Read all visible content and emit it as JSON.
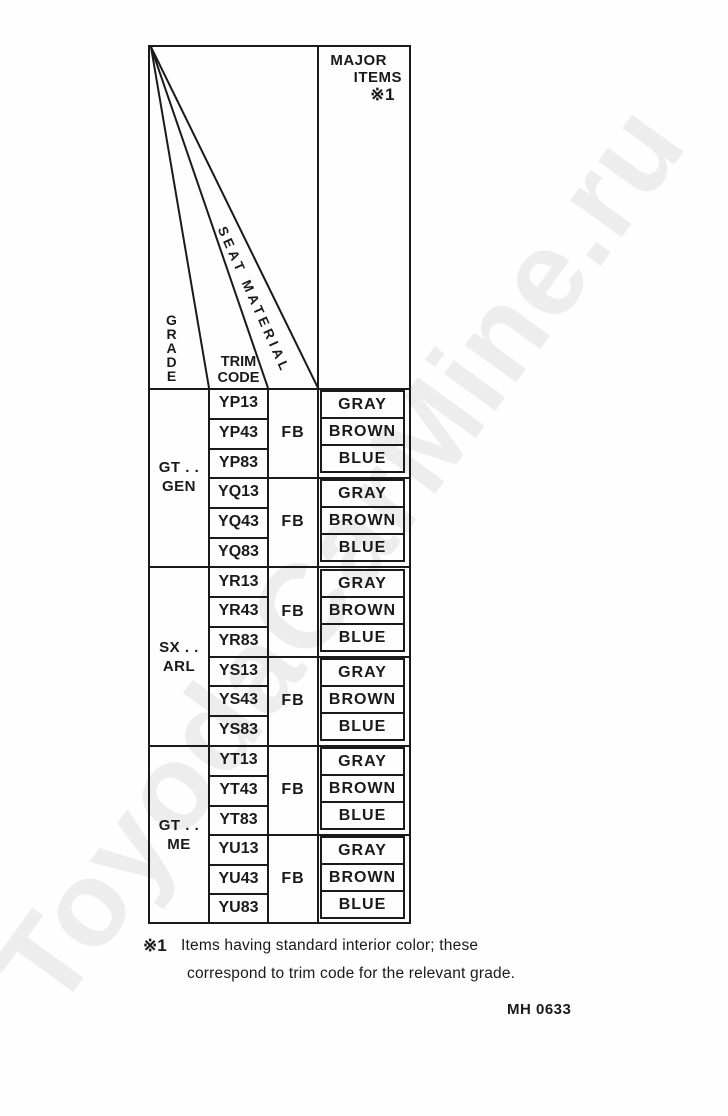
{
  "watermark": {
    "text": "ToyodaCarMine.ru",
    "color": "#ededed"
  },
  "header": {
    "major_items": {
      "line1": "MAJOR",
      "line2": "ITEMS",
      "note_ref": "※1"
    },
    "grade": "GRADE",
    "trim_code": {
      "line1": "TRIM",
      "line2": "CODE"
    },
    "seat_material": "SEAT MATERIAL"
  },
  "table": {
    "groups": [
      {
        "grade": {
          "line1": "GT . .",
          "line2": "GEN"
        },
        "trios": [
          {
            "material": "FB",
            "rows": [
              {
                "trim": "YP13",
                "item": "GRAY"
              },
              {
                "trim": "YP43",
                "item": "BROWN"
              },
              {
                "trim": "YP83",
                "item": "BLUE"
              }
            ]
          },
          {
            "material": "FB",
            "rows": [
              {
                "trim": "YQ13",
                "item": "GRAY"
              },
              {
                "trim": "YQ43",
                "item": "BROWN"
              },
              {
                "trim": "YQ83",
                "item": "BLUE"
              }
            ]
          }
        ]
      },
      {
        "grade": {
          "line1": "SX . .",
          "line2": "ARL"
        },
        "trios": [
          {
            "material": "FB",
            "rows": [
              {
                "trim": "YR13",
                "item": "GRAY"
              },
              {
                "trim": "YR43",
                "item": "BROWN"
              },
              {
                "trim": "YR83",
                "item": "BLUE"
              }
            ]
          },
          {
            "material": "FB",
            "rows": [
              {
                "trim": "YS13",
                "item": "GRAY"
              },
              {
                "trim": "YS43",
                "item": "BROWN"
              },
              {
                "trim": "YS83",
                "item": "BLUE"
              }
            ]
          }
        ]
      },
      {
        "grade": {
          "line1": "GT . .",
          "line2": "ME"
        },
        "trios": [
          {
            "material": "FB",
            "rows": [
              {
                "trim": "YT13",
                "item": "GRAY"
              },
              {
                "trim": "YT43",
                "item": "BROWN"
              },
              {
                "trim": "YT83",
                "item": "BLUE"
              }
            ]
          },
          {
            "material": "FB",
            "rows": [
              {
                "trim": "YU13",
                "item": "GRAY"
              },
              {
                "trim": "YU43",
                "item": "BROWN"
              },
              {
                "trim": "YU83",
                "item": "BLUE"
              }
            ]
          }
        ]
      }
    ]
  },
  "footnote": {
    "symbol": "※1",
    "line1": "Items having standard interior color; these",
    "line2": "correspond to trim code for the relevant grade."
  },
  "doc_ref": "MH 0633",
  "ink_color": "#1a1a1a"
}
